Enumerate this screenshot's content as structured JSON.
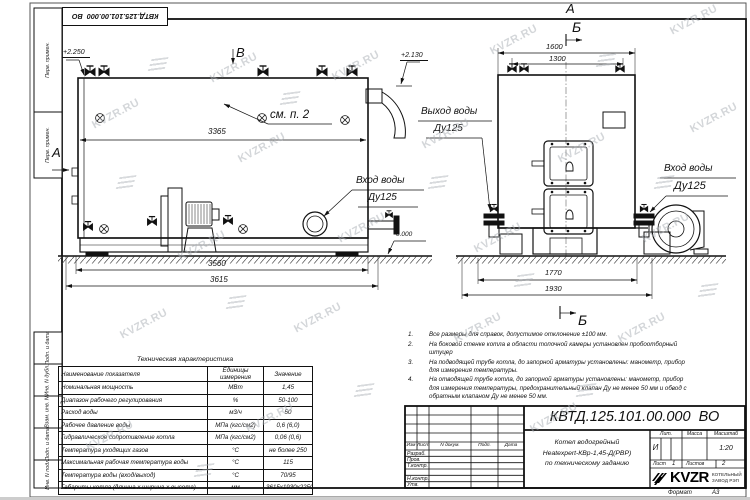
{
  "sheet": {
    "watermark": "KVZR.RU",
    "stamp": "КВТД.125.101.00.000  ВО",
    "format_label": "Формат",
    "format_value": "А3"
  },
  "margin": {
    "f0": "Перв. примен.",
    "f1": "Перв. примен.",
    "f2": "Подп. и дата",
    "f3": "Инв. N дубл.",
    "f4": "Взам. инв. N",
    "f5": "Подп. и дата",
    "f6": "Инв. N подл."
  },
  "side": {
    "view_b": "В",
    "view_a": "А",
    "elev_top": "+2.250",
    "elev_right": "+2.130",
    "elev_zero": "0.000",
    "callout": "см. п. 2",
    "dim_body": "3365",
    "dim_mid": "3560",
    "dim_total": "3615",
    "inlet1": "Вход воды",
    "inlet2": "Ду125"
  },
  "rear": {
    "view_a": "А",
    "view_b_top": "Б",
    "view_b_bottom": "Б",
    "dim_top_outer": "1600",
    "dim_top_inner": "1300",
    "dim_bot_inner": "1770",
    "dim_bot_outer": "1930",
    "outlet1": "Выход воды",
    "outlet2": "Ду125",
    "inlet1": "Вход воды",
    "inlet2": "Ду125"
  },
  "notes": [
    {
      "n": "1.",
      "t": "Все размеры для справок, допустимое отклонение ±100 мм."
    },
    {
      "n": "2.",
      "t": "На боковой стенке котла в области топочной камеры установлен пробоотборный штуцер"
    },
    {
      "n": "3.",
      "t": "На подводящей трубе котла, до запорной арматуры установлены: манометр, прибор для измерения температуры."
    },
    {
      "n": "4.",
      "t": "На отводящей трубе котла, до запорной арматуры установлены: манометр, прибор для измерения температуры, предохранительный клапан Ду не менее 50 мм и обвод с обратным клапаном Ду не менее 50 мм."
    }
  ],
  "spec": {
    "title": "Техническая характеристика",
    "headers": [
      "Наименование показателя",
      "Единицы измерения",
      "Значение"
    ],
    "rows": [
      [
        "Номинальная мощность",
        "МВт",
        "1,45"
      ],
      [
        "Диапазон рабочего регулирования",
        "%",
        "50-100"
      ],
      [
        "Расход воды",
        "м3/ч",
        "50"
      ],
      [
        "Рабочее давление воды",
        "МПа (кгс/см2)",
        "0,6 (6,0)"
      ],
      [
        "Гидравлическое сопротивление котла",
        "МПа (кгс/см2)",
        "0,06 (0,6)"
      ],
      [
        "Температура уходящих газов",
        "°С",
        "не более 250"
      ],
      [
        "Максимальная рабочая температура воды",
        "°С",
        "115"
      ],
      [
        "Температура воды (вход/выход)",
        "°С",
        "70/95"
      ],
      [
        "Габариты котла (длинна х ширина х высота)",
        "мм",
        "3615х1930х2250"
      ]
    ]
  },
  "tb": {
    "designation": "КВТД.125.101.00.000  ВО",
    "name1": "Котел водогрейный",
    "name2": "Heatexpert-КВр-1,45-Д(РВР)",
    "name3": "по техническому заданию",
    "c_izm": "Изм",
    "c_list": "Лист",
    "c_doc": "N докум.",
    "c_podp": "Подп.",
    "c_data": "Дата",
    "r0": "Разраб.",
    "r1": "Пров.",
    "r2": "Т.контр.",
    "r3": "Н.контр.",
    "r4": "Утв.",
    "lit_l": "Лит.",
    "lit_v": "И",
    "mass_l": "Масса",
    "scale_l": "Масштаб",
    "scale_v": "1:20",
    "sheet_l": "Лист",
    "sheet_v": "1",
    "sheets_l": "Листов",
    "sheets_v": "2",
    "logo": "KVZR",
    "co1": "КОТЕЛЬНЫЙ",
    "co2": "ЗАВОД РЭП"
  }
}
